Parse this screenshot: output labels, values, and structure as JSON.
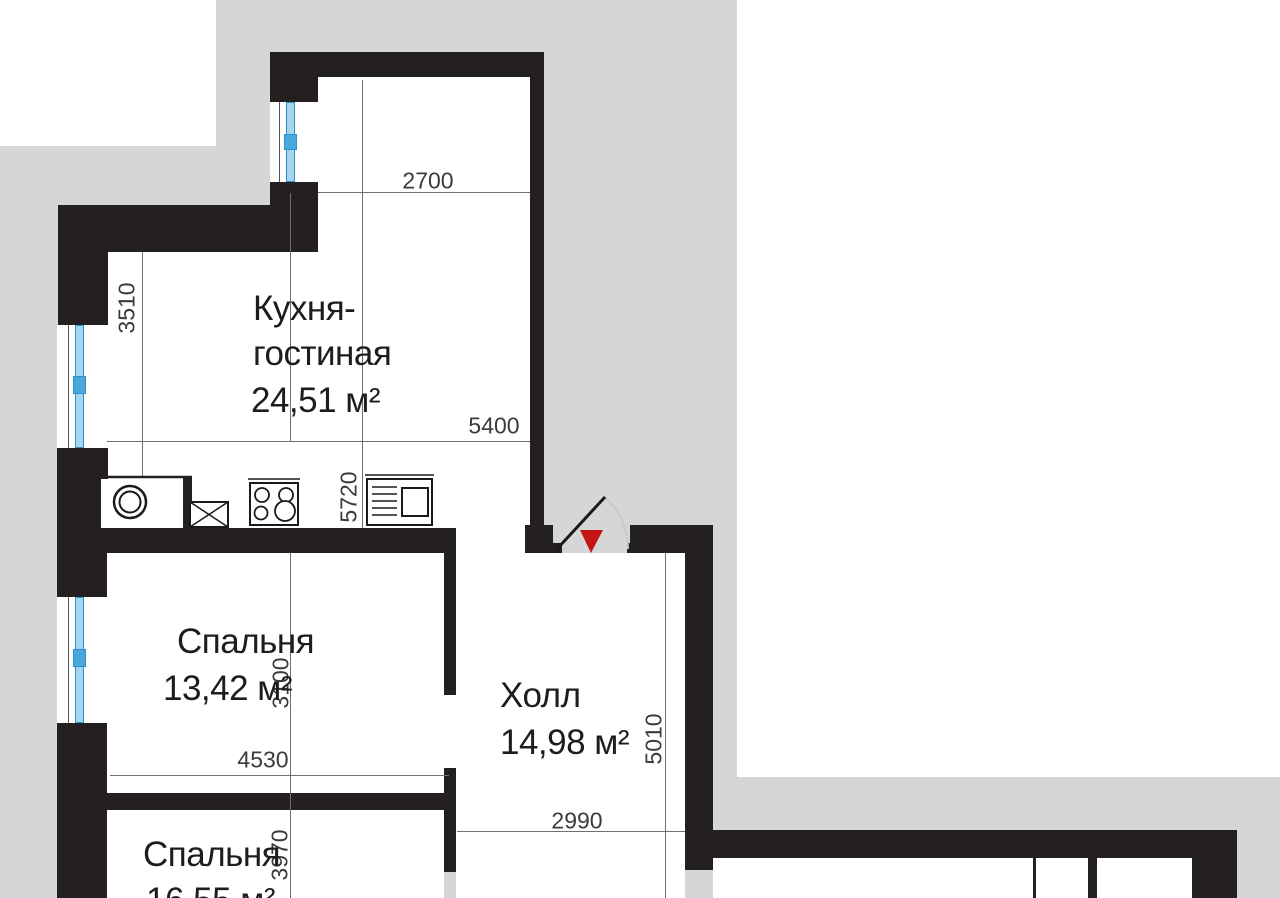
{
  "plan": {
    "type": "apartment floor plan",
    "rooms": [
      {
        "id": "kitchen-living",
        "name_line1": "Кухня-",
        "name_line2": "гостиная",
        "area": "24,51 м²"
      },
      {
        "id": "bedroom-1",
        "name": "Спальня",
        "area": "13,42 м²"
      },
      {
        "id": "hall",
        "name": "Холл",
        "area": "14,98 м²"
      },
      {
        "id": "bedroom-2",
        "name": "Спальня",
        "area": "16,55 м²"
      }
    ],
    "dimensions_mm": {
      "kitchen_top_width": "2700",
      "kitchen_left_height": "3510",
      "kitchen_width": "5400",
      "kitchen_height": "5720",
      "bedroom1_height": "3100",
      "bedroom1_width": "4530",
      "hall_height": "5010",
      "hall_width": "2990",
      "bedroom2_height": "3970"
    },
    "icons": [
      "washing-machine",
      "sink",
      "stove",
      "refrigerator",
      "entrance-marker",
      "door-swing"
    ],
    "colors": {
      "background": "#d5d7d6",
      "walls": "#241f20",
      "interior": "#ffffff",
      "window_glass": "#a5d5ef",
      "window_frame": "#2f8fc9",
      "entrance_marker": "#c41414",
      "dimension_lines": "#6f6f6f",
      "dimension_text": "#3b3b3b",
      "door_arc": "#c9cbca"
    }
  }
}
